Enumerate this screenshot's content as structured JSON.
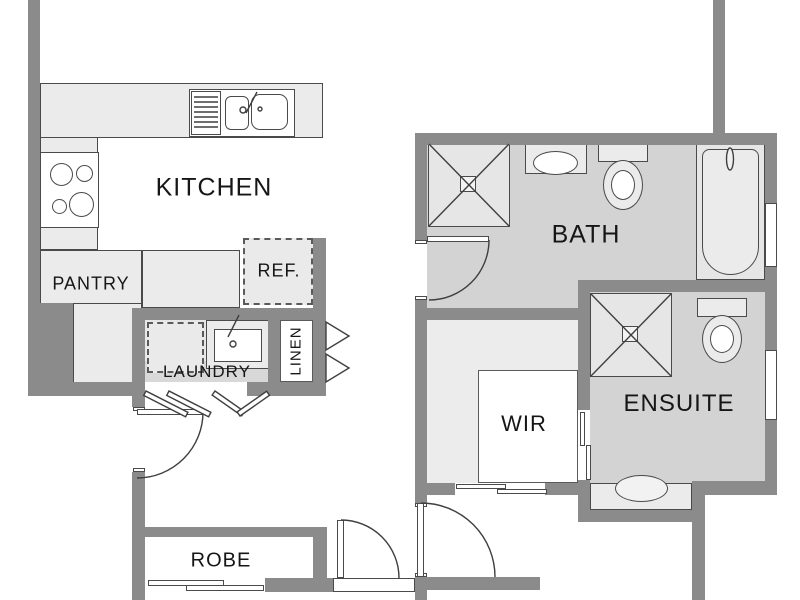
{
  "plan_type": "residential floor plan (kitchen / laundry / bathroom wing)",
  "rooms": {
    "kitchen": "KITCHEN",
    "pantry": "PANTRY",
    "ref": "REF.",
    "laundry": "LAUNDRY",
    "linen": "LINEN",
    "bath": "BATH",
    "wir": "WIR",
    "ensuite": "ENSUITE",
    "robe": "ROBE"
  },
  "fixtures": [
    "kitchen-sink-double-bowl",
    "cooktop-4-burner",
    "laundry-tub",
    "washing-machine-space-dashed",
    "refrigerator-space-dashed",
    "bath-shower",
    "bath-vanity-basin",
    "bath-toilet",
    "bathtub",
    "ensuite-shower",
    "ensuite-toilet",
    "ensuite-vanity-basin",
    "linen-bifold-doors",
    "laundry-bifold-doors",
    "robe-sliding-door",
    "wir-sliding-door",
    "ensuite-cavity-slider",
    "hinged-doors",
    "windows"
  ],
  "colors": {
    "wall": "#8b8b8b",
    "room_floor": "#d3d3d3",
    "fixture_fill": "#ebebeb",
    "outline": "#444444",
    "background": "#ffffff",
    "text": "#161616"
  }
}
